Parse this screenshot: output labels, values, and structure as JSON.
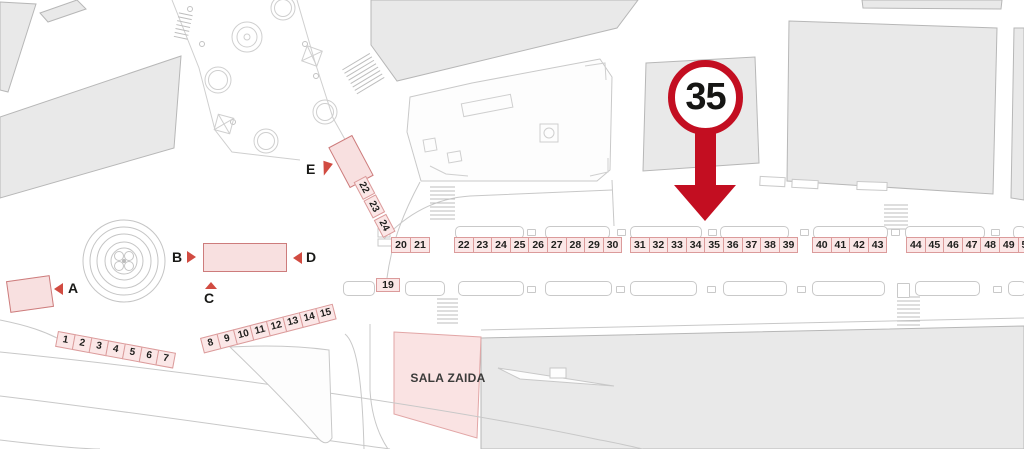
{
  "map": {
    "marker": {
      "value": "35"
    },
    "sala_label": "SALA ZAIDA",
    "gates": [
      "A",
      "B",
      "C",
      "D",
      "E"
    ],
    "stalls": {
      "g1": [
        "1",
        "2",
        "3",
        "4",
        "5",
        "6",
        "7"
      ],
      "g2": [
        "8",
        "9",
        "10",
        "11",
        "12",
        "13",
        "14",
        "15"
      ],
      "g19": "19",
      "g20": [
        "20",
        "21"
      ],
      "gcol": [
        "22",
        "23",
        "24"
      ],
      "r1": [
        "22",
        "23",
        "24",
        "25",
        "26",
        "27",
        "28",
        "29",
        "30"
      ],
      "r2": [
        "31",
        "32",
        "33",
        "34",
        "35",
        "36",
        "37",
        "38",
        "39"
      ],
      "r3": [
        "40",
        "41",
        "42",
        "43"
      ],
      "r4": [
        "44",
        "45",
        "46",
        "47",
        "48",
        "49",
        "50"
      ]
    },
    "colors": {
      "marker_red": "#c30e21",
      "gate_red": "#d14b41",
      "stall_pink": "#fbe7e7",
      "stall_border": "#db9b9b"
    }
  }
}
